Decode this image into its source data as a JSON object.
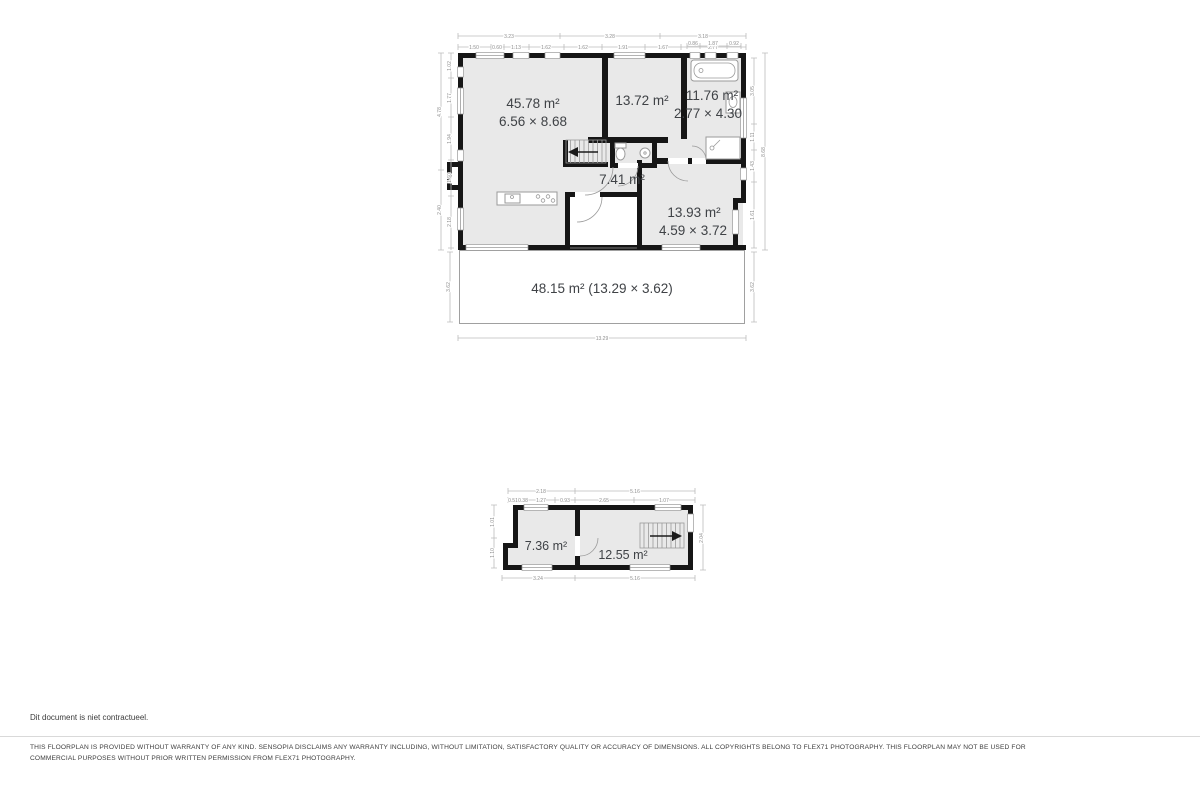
{
  "footer": {
    "note": "Dit document is niet contractueel.",
    "disclaimer_line1": "THIS FLOORPLAN IS PROVIDED WITHOUT WARRANTY OF ANY KIND. SENSOPIA DISCLAIMS ANY WARRANTY INCLUDING, WITHOUT LIMITATION, SATISFACTORY QUALITY OR ACCURACY OF DIMENSIONS. ALL COPYRIGHTS BELONG TO FLEX71 PHOTOGRAPHY. THIS FLOORPLAN MAY NOT BE USED FOR",
    "disclaimer_line2": "COMMERCIAL PURPOSES WITHOUT PRIOR WRITTEN PERMISSION FROM FLEX71 PHOTOGRAPHY."
  },
  "main_floor": {
    "rooms": {
      "living": {
        "area": "45.78 m²",
        "dims": "6.56 × 8.68"
      },
      "room_top": {
        "area": "13.72 m²"
      },
      "bathroom": {
        "area": "11.76 m²",
        "dims": "2.77 × 4.30"
      },
      "hall": {
        "area": "7.41 m²"
      },
      "room_right": {
        "area": "13.93 m²",
        "dims": "4.59 × 3.72"
      },
      "terrace": {
        "label": "48.15 m² (13.29 × 3.62)"
      }
    },
    "dims": {
      "top_outer": [
        "3.23",
        "3.28",
        "3.18"
      ],
      "top_inner": [
        "1.50",
        "0.60",
        "1.13",
        "1.62",
        "1.62",
        "1.91",
        "1.67",
        "2.77"
      ],
      "top_inner2": [
        "0.86",
        "1.87",
        "0.92"
      ],
      "left_outer": [
        "4.78",
        "2.40"
      ],
      "left_inner": [
        "1.02",
        "1.77",
        "1.94",
        "1.60",
        "2.18"
      ],
      "right_outer": [
        "8.68"
      ],
      "right_inner": [
        "3.05",
        "1.11",
        "1.43",
        "1.61"
      ],
      "bottom": [
        "13.29"
      ],
      "terrace_left": "3.62",
      "terrace_right": "3.62"
    }
  },
  "lower_floor": {
    "rooms": {
      "room_left": {
        "area": "7.36 m²"
      },
      "room_right": {
        "area": "12.55 m²"
      }
    },
    "dims": {
      "top_outer": [
        "2.18",
        "5.16"
      ],
      "top_inner": [
        "0.51",
        "0.38",
        "1.27",
        "0.93",
        "2.65",
        "1.07"
      ],
      "bottom": [
        "3.24",
        "5.16"
      ],
      "left": [
        "1.01",
        "1.10"
      ],
      "right": [
        "2.04"
      ]
    }
  },
  "colors": {
    "floor_fill": "#e9e9e9",
    "wall": "#161616",
    "label_text": "#3f4246",
    "dim_line": "#bcbcbc",
    "dim_text": "#8f8f8f"
  }
}
